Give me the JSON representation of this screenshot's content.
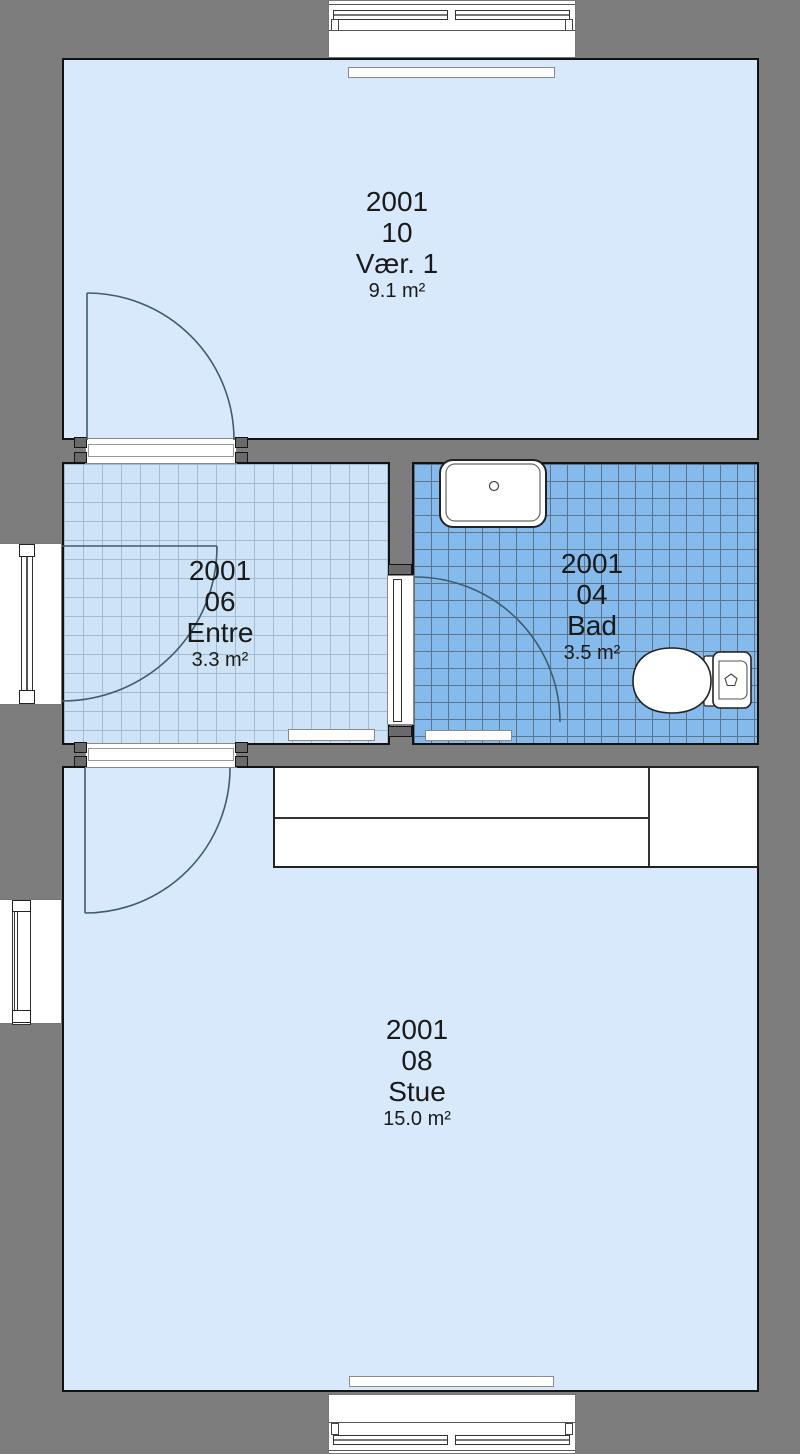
{
  "plan": {
    "type": "floor-plan",
    "rooms": [
      {
        "code": "2001",
        "number": "10",
        "name": "Vær. 1",
        "area": "9.1 m²"
      },
      {
        "code": "2001",
        "number": "06",
        "name": "Entre",
        "area": "3.3 m²"
      },
      {
        "code": "2001",
        "number": "04",
        "name": "Bad",
        "area": "3.5 m²"
      },
      {
        "code": "2001",
        "number": "08",
        "name": "Stue",
        "area": "15.0 m²"
      }
    ],
    "fixtures": [
      "washbasin",
      "toilet",
      "kitchen-counter",
      "radiator"
    ],
    "colors": {
      "wall": "#7d7d7d",
      "room_fill": "#d9e9fc",
      "entre_fill": "#cfe3f7",
      "entre_grid": "#a3bad6",
      "bad_fill": "#85bbec",
      "bad_grid": "#5f7488",
      "outline": "#121212",
      "door_arc": "#3d5c6e",
      "text": "#1a1a1a"
    }
  }
}
